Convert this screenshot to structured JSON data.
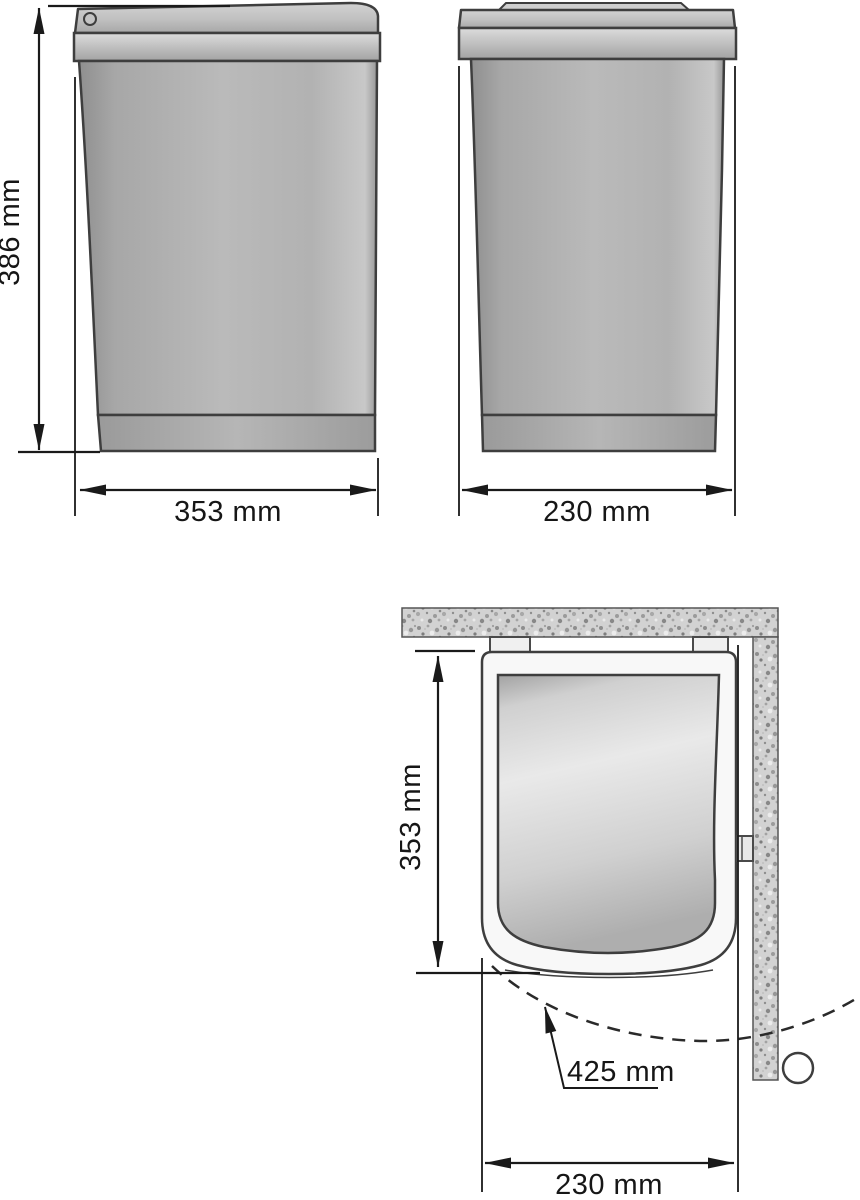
{
  "diagram": {
    "title": "built-in waste bin dimension drawing",
    "front_view": {
      "height_label": "386 mm",
      "width_label": "353 mm"
    },
    "side_view": {
      "width_label": "230 mm"
    },
    "top_view": {
      "depth_label": "353 mm",
      "swing_label": "425 mm",
      "width_label": "230 mm"
    },
    "colors": {
      "outline": "#3e3e3e",
      "dimension_line": "#1a1a1a",
      "body_gray": "#b5b5b5",
      "texture_base": "#d2d2d2",
      "background": "#ffffff"
    }
  }
}
